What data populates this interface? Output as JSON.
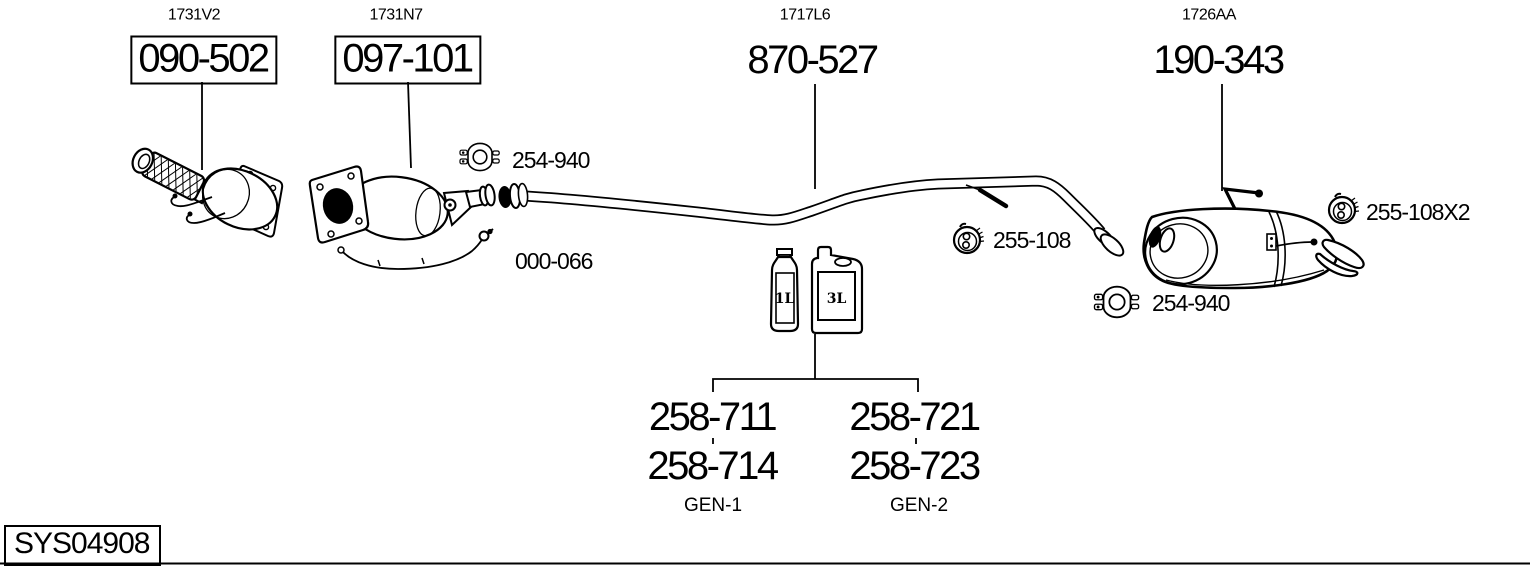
{
  "system_code": "SYS04908",
  "colors": {
    "ink": "#000000",
    "paper": "#ffffff"
  },
  "assemblies": [
    {
      "ref": "1731V2",
      "part": "090-502",
      "component": "catalytic-converter"
    },
    {
      "ref": "1731N7",
      "part": "097-101",
      "component": "particulate-filter"
    },
    {
      "ref": "1717L6",
      "part": "870-527",
      "component": "center-pipe"
    },
    {
      "ref": "1726AA",
      "part": "190-343",
      "component": "rear-muffler"
    }
  ],
  "callouts": {
    "clamp_front": "254-940",
    "sensor_harness": "000-066",
    "hanger_center": "255-108",
    "hanger_rear": "255-108X2",
    "clamp_rear": "254-940"
  },
  "additives": {
    "small_container_label": "1L",
    "large_container_label": "3L",
    "options": [
      {
        "generation": "GEN-1",
        "parts": [
          "258-711",
          "258-714"
        ]
      },
      {
        "generation": "GEN-2",
        "parts": [
          "258-721",
          "258-723"
        ]
      }
    ]
  }
}
